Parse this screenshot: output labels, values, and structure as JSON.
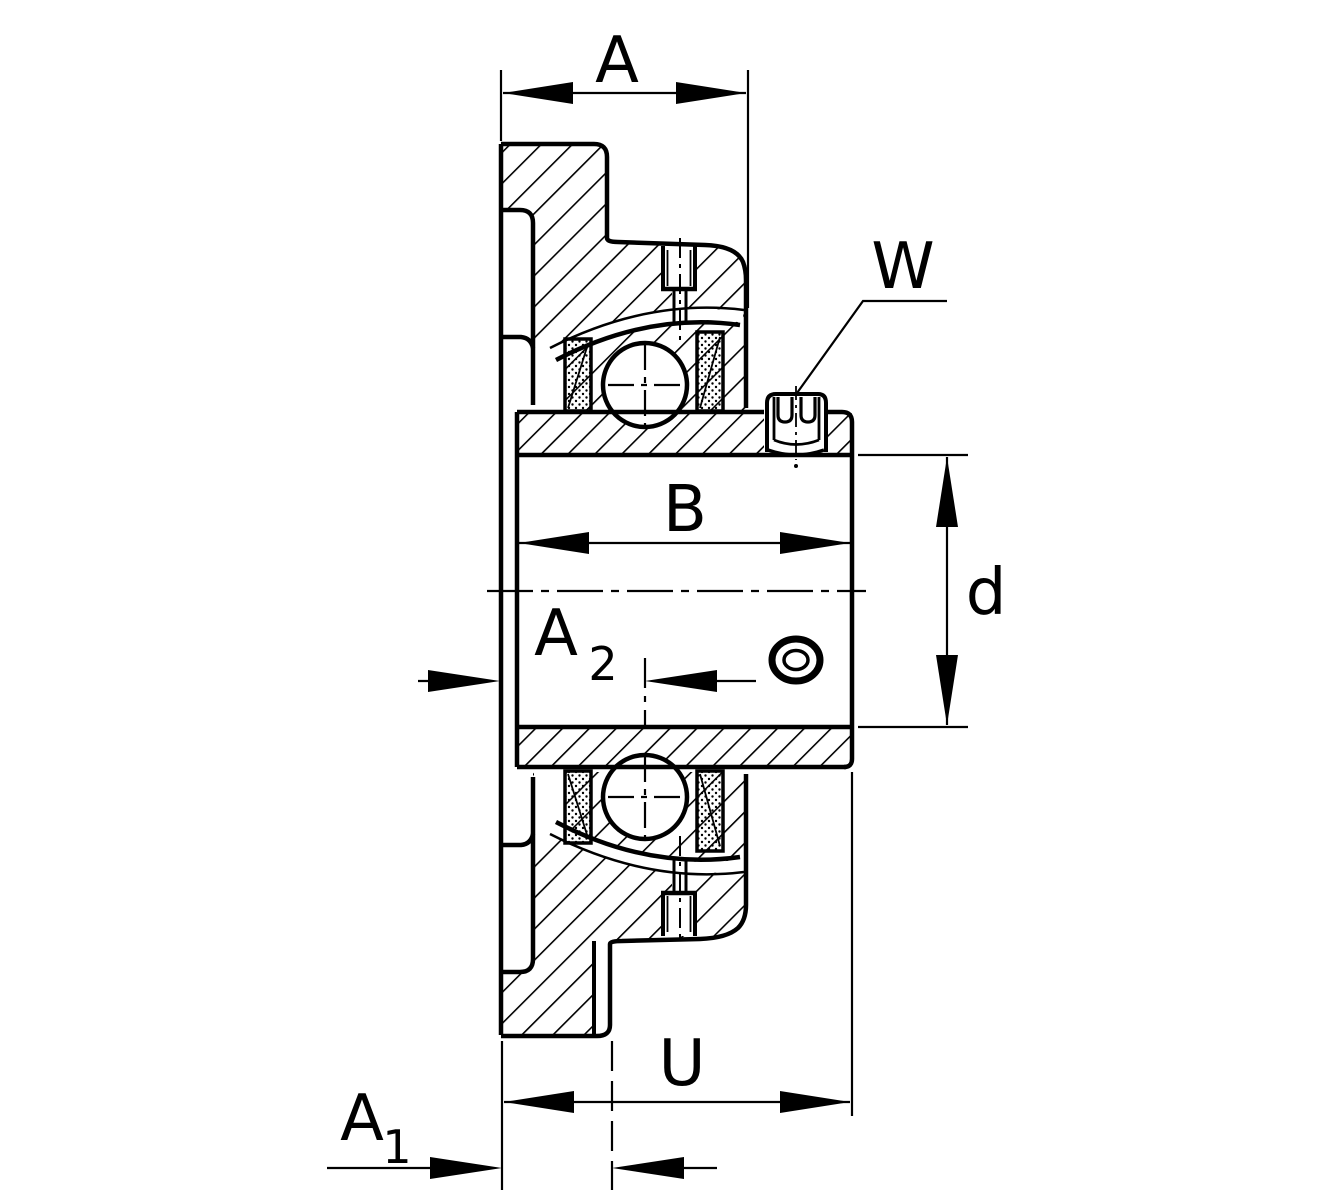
{
  "figure": {
    "type": "technical-drawing",
    "subject": "flanged bearing unit cross-section"
  },
  "colors": {
    "line": "#000000",
    "background": "#ffffff"
  },
  "dims": {
    "a": {
      "label": "A"
    },
    "w": {
      "label": "W"
    },
    "b": {
      "label": "B"
    },
    "d": {
      "label": "d"
    },
    "a2": {
      "base": "A",
      "sub": "2"
    },
    "u": {
      "label": "U"
    },
    "a1": {
      "base": "A",
      "sub": "1"
    }
  }
}
